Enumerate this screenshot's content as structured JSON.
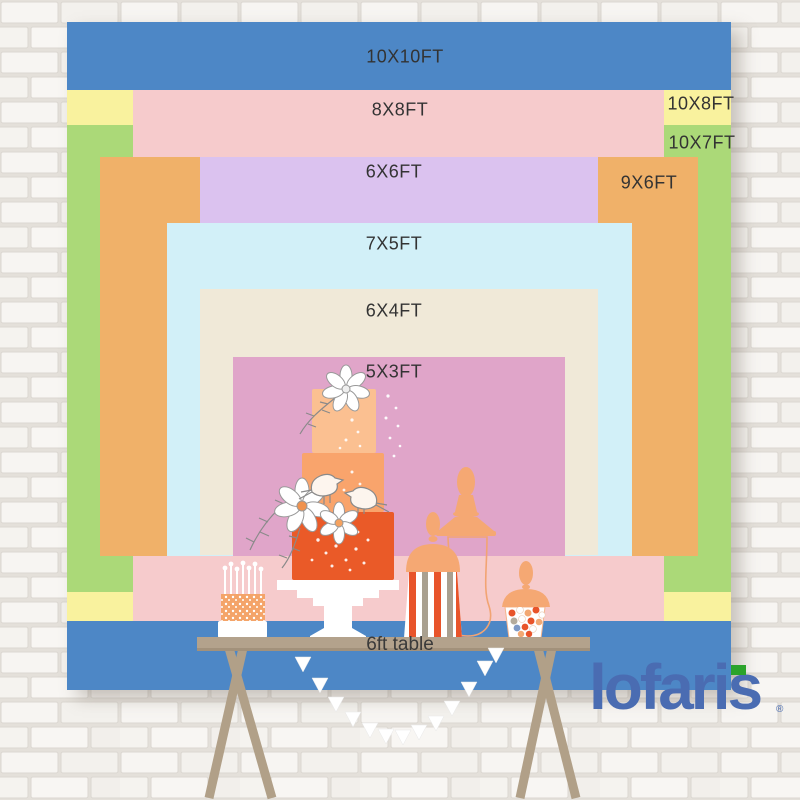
{
  "sizes": [
    {
      "id": "10x10ft",
      "label": "10X10FT",
      "color": "#4d87c6"
    },
    {
      "id": "10x8ft",
      "label": "10X8FT",
      "color": "#f9f29e"
    },
    {
      "id": "10x7ft",
      "label": "10X7FT",
      "color": "#abd978"
    },
    {
      "id": "8x8ft",
      "label": "8X8FT",
      "color": "#f6cbcc"
    },
    {
      "id": "9x6ft",
      "label": "9X6FT",
      "color": "#f0b169"
    },
    {
      "id": "6x6ft",
      "label": "6X6FT",
      "color": "#dbc2ef"
    },
    {
      "id": "7x5ft",
      "label": "7X5FT",
      "color": "#d2f0f8"
    },
    {
      "id": "6x4ft",
      "label": "6X4FT",
      "color": "#f0e9d8"
    },
    {
      "id": "5x3ft",
      "label": "5X3FT",
      "color": "#e0a5c9"
    }
  ],
  "table": {
    "label": "6ft table",
    "color": "#b3a28c"
  },
  "brand": {
    "name": "lofaris",
    "registered_mark": "®",
    "logo_color": "#4a6cb2",
    "flag_color": "#2ba32b"
  },
  "scene": {
    "wall": "white-brick-wall",
    "decorations": [
      "tiered-cake-icon",
      "candle-cake-icon",
      "popcorn-jar-icon",
      "candy-jar-icon",
      "apothecary-lid-icon",
      "glass-vase-icon",
      "bunting-garland-icon",
      "trestle-table"
    ]
  }
}
